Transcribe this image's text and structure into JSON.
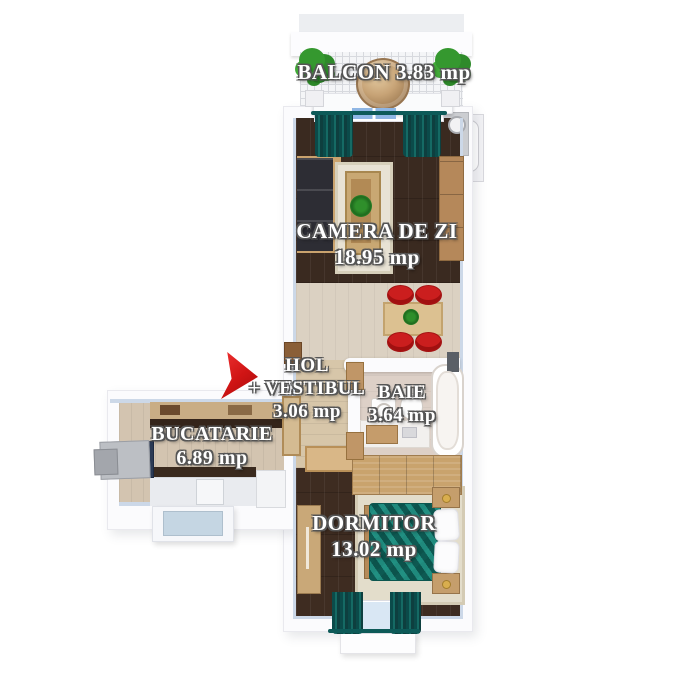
{
  "plan": {
    "type": "apartment-floorplan",
    "language": "ro",
    "rooms": {
      "balcon": {
        "name": "BALCON",
        "area": "3.83 mp"
      },
      "camera_de_zi": {
        "name": "CAMERA DE ZI",
        "area": "18.95 mp"
      },
      "hol": {
        "line1": "HOL",
        "line2": "+ VESTIBUL",
        "area": "3.06 mp"
      },
      "baie": {
        "name": "BAIE",
        "area": "3.64 mp"
      },
      "bucatarie": {
        "name": "BUCATARIE",
        "area": "6.89 mp"
      },
      "dormitor": {
        "name": "DORMITOR",
        "area": "13.02 mp"
      }
    },
    "marker": {
      "shape": "arrow-right",
      "color": "#d01414"
    },
    "colors": {
      "background": "#ffffff",
      "walls": "#fbfbfd",
      "wall_inner_edge": "#ccd8e8",
      "dark_wood_floor": "#3a2a20",
      "dining_floor": "#dbd1c2",
      "hol_floor": "#d7c6a9",
      "kitchen_floor": "#d3c4b0",
      "bath_floor": "#ddd0c7",
      "furniture_wood": "#c49a66",
      "textile_teal": "#15756c",
      "curtain_teal": "#0c4f4e",
      "chair_red": "#cb1e1e",
      "plant_green": "#35982f",
      "label_text": "#ffffff",
      "label_outline": "#555555"
    }
  }
}
